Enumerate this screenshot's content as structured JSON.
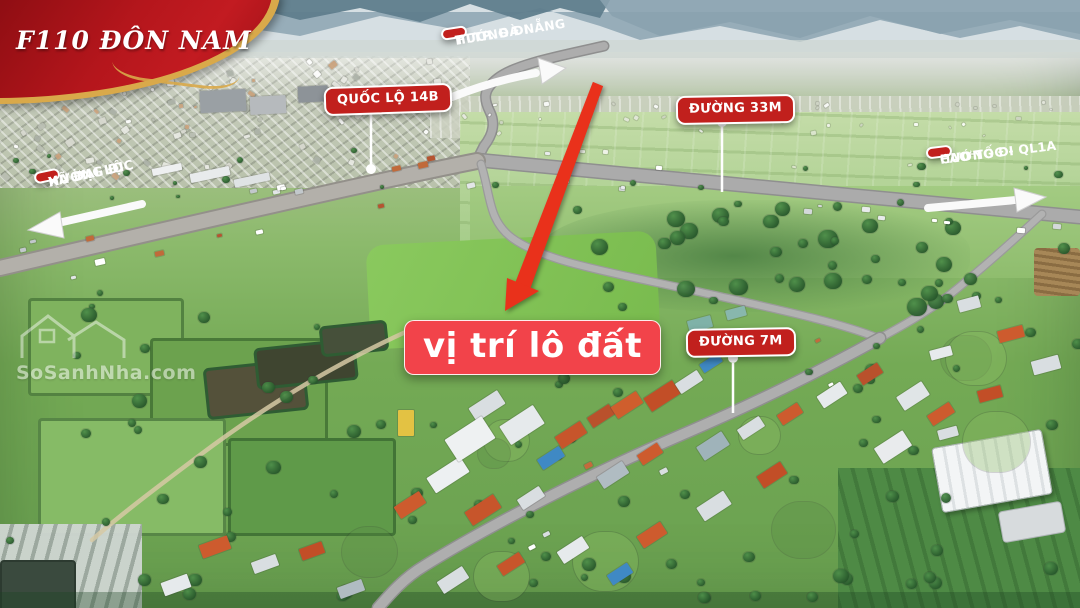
{
  "banner": {
    "title": "F110 ĐÔN NAM"
  },
  "labels": {
    "danang": {
      "line1": "HƯỚNG ĐI",
      "line2": "TTTP. ĐÀ NẴNG"
    },
    "ql14b": {
      "text": "QUỐC LỘ 14B"
    },
    "road33m": {
      "text": "ĐƯỜNG 33M"
    },
    "caotoc": {
      "line1": "HƯỚNG ĐI",
      "line2": "CAO TỐC - QL1A"
    },
    "dailoc": {
      "line1": "HƯỚNG ĐI",
      "line2": "XÃ ĐẠI LỘC"
    },
    "plot": {
      "text": "vị trí lô đất"
    },
    "road7m": {
      "text": "ĐƯỜNG 7M"
    }
  },
  "watermark": {
    "text": "SoSanhNha.com"
  },
  "icons": {
    "location_arrow": "big red arrow pointing to plot",
    "direction_arrows": "white road direction arrows",
    "pointer_pins": "white pin lines from road labels to roads",
    "watermark_house": "outlined twin-house logo"
  },
  "colors": {
    "label_red": "#c1201d",
    "plot_red": "#f2434a",
    "arrow_red": "#e9311b",
    "ribbon_red": "#a31118",
    "ribbon_gold": "#d9a94a",
    "road_gray": "#a9a9a9"
  }
}
